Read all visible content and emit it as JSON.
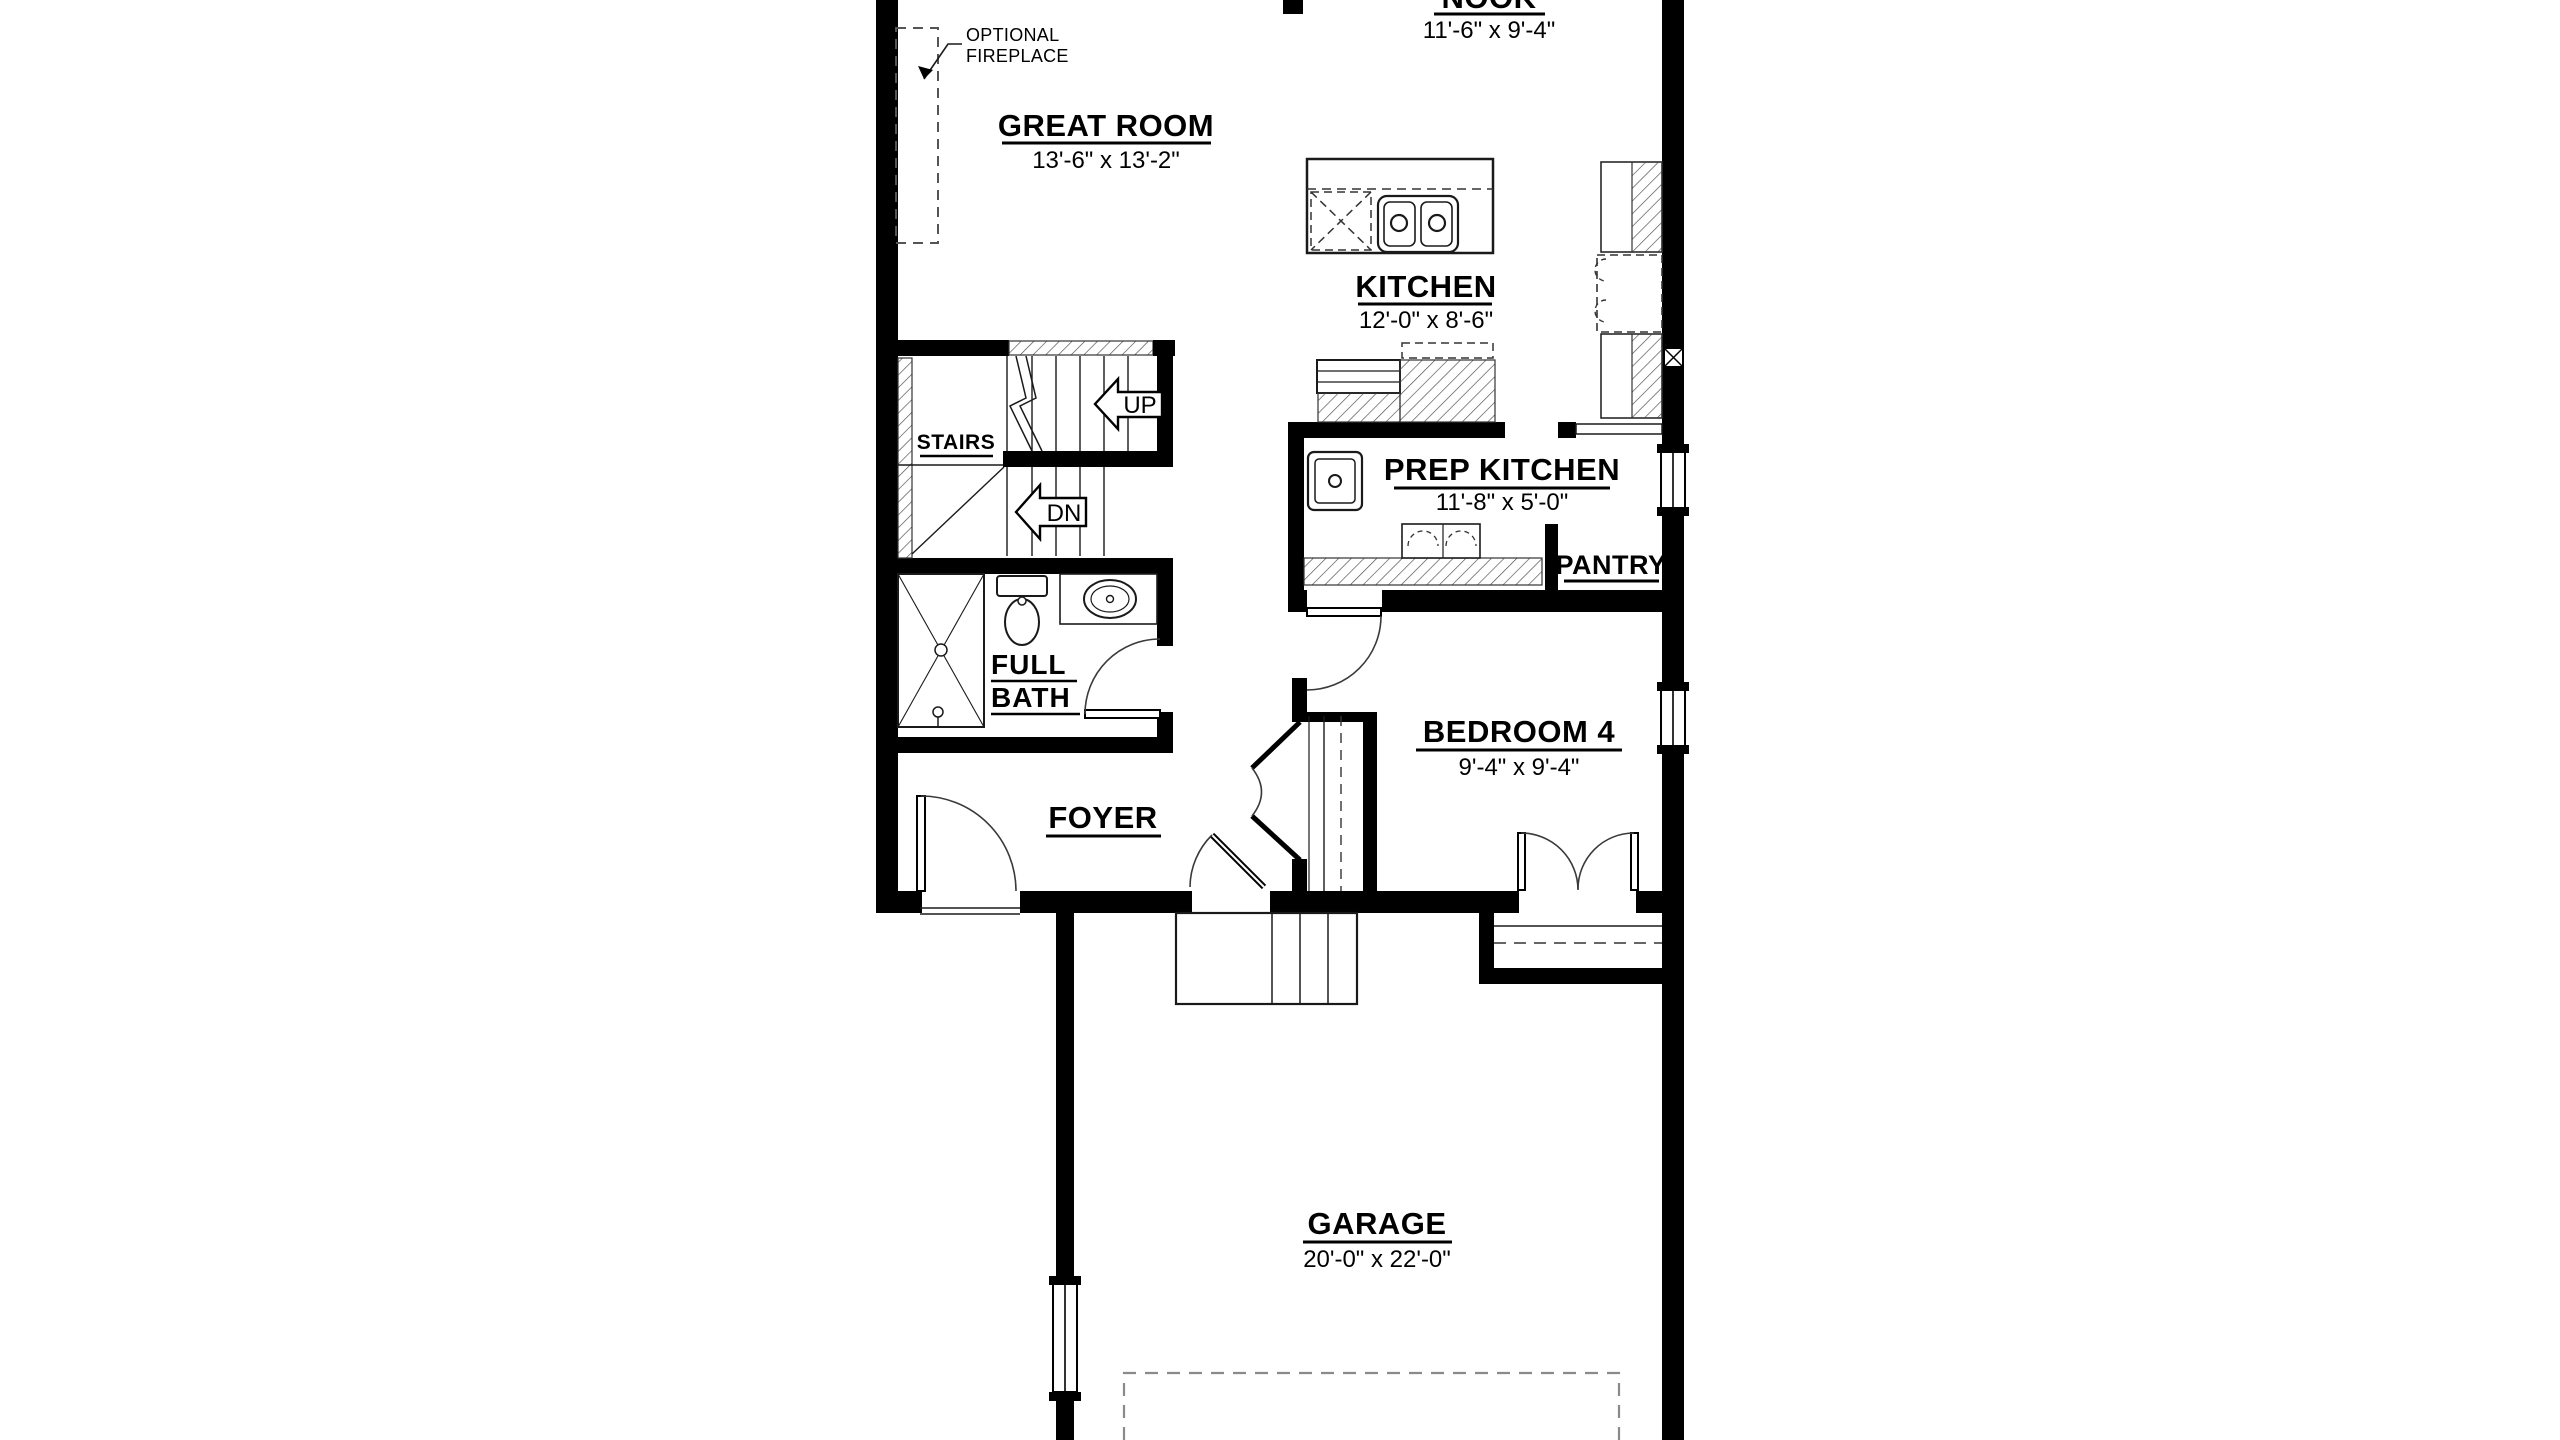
{
  "rooms": {
    "nook": {
      "name": "NOOK",
      "dims": "11'-6\" x 9'-4\""
    },
    "great_room": {
      "name": "GREAT ROOM",
      "dims": "13'-6\" x 13'-2\""
    },
    "kitchen": {
      "name": "KITCHEN",
      "dims": "12'-0\" x 8'-6\""
    },
    "prep_kitchen": {
      "name": "PREP KITCHEN",
      "dims": "11'-8\" x 5'-0\""
    },
    "pantry": {
      "name": "PANTRY"
    },
    "stairs": {
      "name": "STAIRS"
    },
    "full_bath": {
      "line1": "FULL",
      "line2": "BATH"
    },
    "foyer": {
      "name": "FOYER"
    },
    "bedroom4": {
      "name": "BEDROOM 4",
      "dims": "9'-4\" x 9'-4\""
    },
    "garage": {
      "name": "GARAGE",
      "dims": "20'-0\" x 22'-0\""
    }
  },
  "stair_arrows": {
    "up": "UP",
    "down": "DN"
  },
  "annotations": {
    "fireplace_line1": "OPTIONAL",
    "fireplace_line2": "FIREPLACE"
  },
  "colors": {
    "wall": "#000000",
    "background": "#ffffff",
    "hatch_line": "#4a4a4a",
    "dashed_line": "#8a8a8a"
  }
}
